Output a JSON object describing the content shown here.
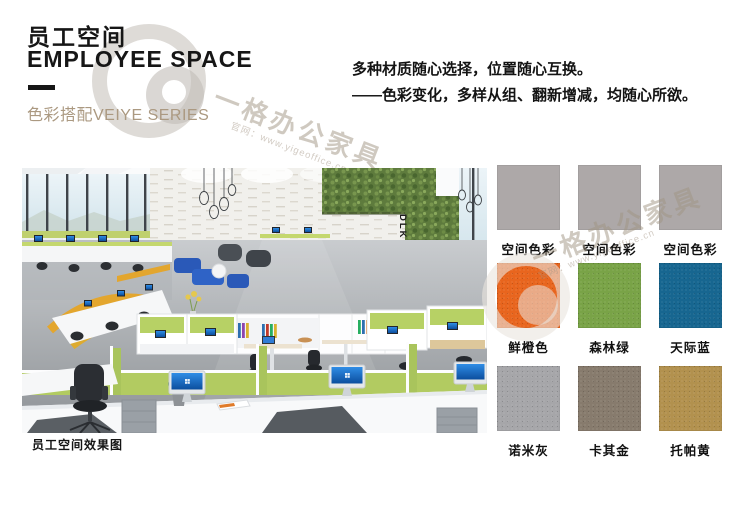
{
  "header": {
    "title_zh": "员工空间",
    "title_en": "EMPLOYEE SPACE",
    "series_label": "色彩搭配VEIYE SERIES",
    "tagline": {
      "line1": "多种材质随心选择，位置随心互换。",
      "line2": "——色彩变化，多样从组、翻新增减，均随心所欲。"
    }
  },
  "watermark": {
    "brand": "一格办公家具",
    "site": "官网：www.yigeoffice.cn"
  },
  "office_image": {
    "caption": "员工空间效果图",
    "wall_text": "DLK.2018"
  },
  "swatches": {
    "items": [
      {
        "label": "空间色彩",
        "color": "#ada8a8"
      },
      {
        "label": "空间色彩",
        "color": "#ada8a8"
      },
      {
        "label": "空间色彩",
        "color": "#ada8a8"
      },
      {
        "label": "鲜橙色",
        "color": "#e8651e"
      },
      {
        "label": "森林绿",
        "color": "#79a347"
      },
      {
        "label": "天际蓝",
        "color": "#176690"
      },
      {
        "label": "诺米灰",
        "color": "#a6a6a9"
      },
      {
        "label": "卡其金",
        "color": "#877b6d"
      },
      {
        "label": "托帕黄",
        "color": "#b2914e"
      }
    ]
  }
}
